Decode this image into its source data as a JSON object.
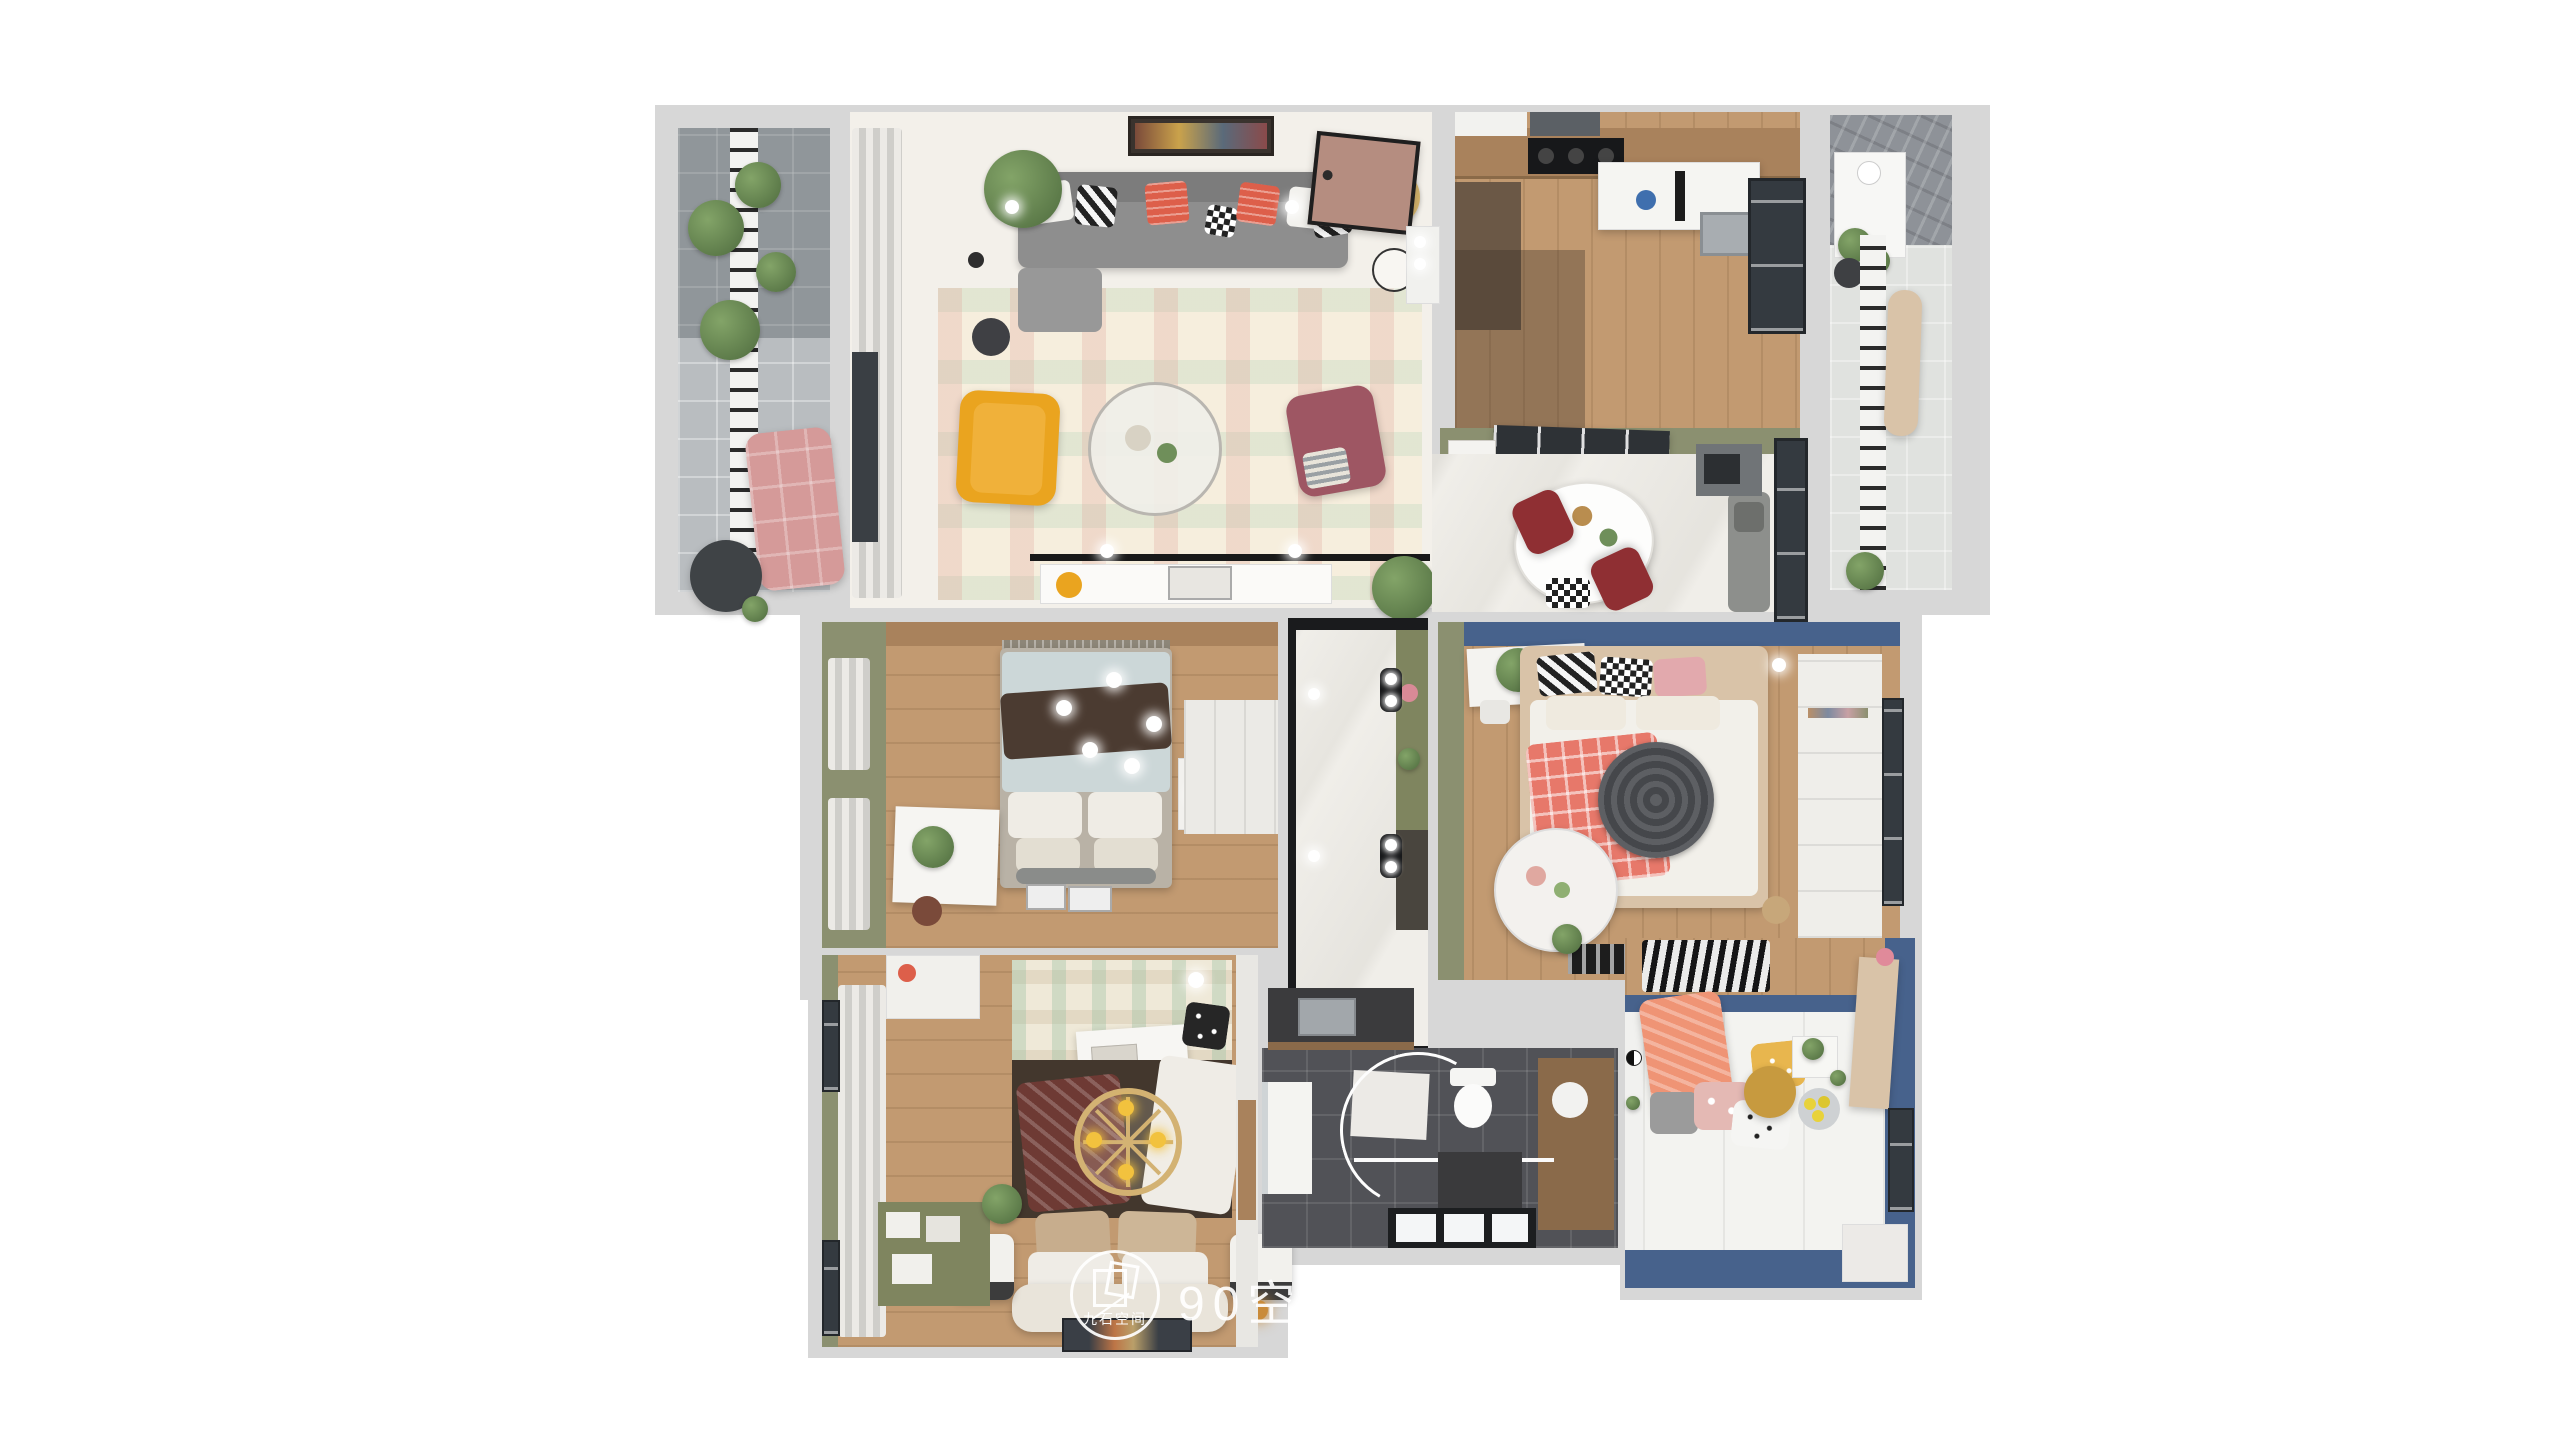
{
  "watermark": {
    "brand_text": "90空间设计工",
    "logo_text": "九石空间"
  },
  "palette": {
    "wall": "#d7d7d7",
    "floor": "#f3f0ea",
    "marble": "#efece7",
    "wood": "#c29a71",
    "wood_dark": "#a9825c",
    "olive": "#8b9070",
    "olive_dark": "#7f855f",
    "blue": "#47628c",
    "dark_tile": "#515257",
    "balcony_tile": "#b9bdc0",
    "curtain": "#dcdbd6",
    "sofa": "#8e8e8e",
    "coral": "#dd5f4a",
    "yellow": "#eaa41f",
    "mauve": "#9e5663",
    "red_chair": "#8f2f33",
    "pink": "#d59a99",
    "door": "#b58d80",
    "duvet": "#ccd7d8",
    "throw": "#4b3b31",
    "blanket": "#e7786a",
    "duvet_dark": "#43372d",
    "tan": "#c7ad8d",
    "orange": "#ef9475",
    "beige": "#d9c3a8",
    "railing": "#2b2b2b",
    "plant": "#5d7a4e",
    "white_furn": "#f4f3f0",
    "glass": "#343a40"
  }
}
